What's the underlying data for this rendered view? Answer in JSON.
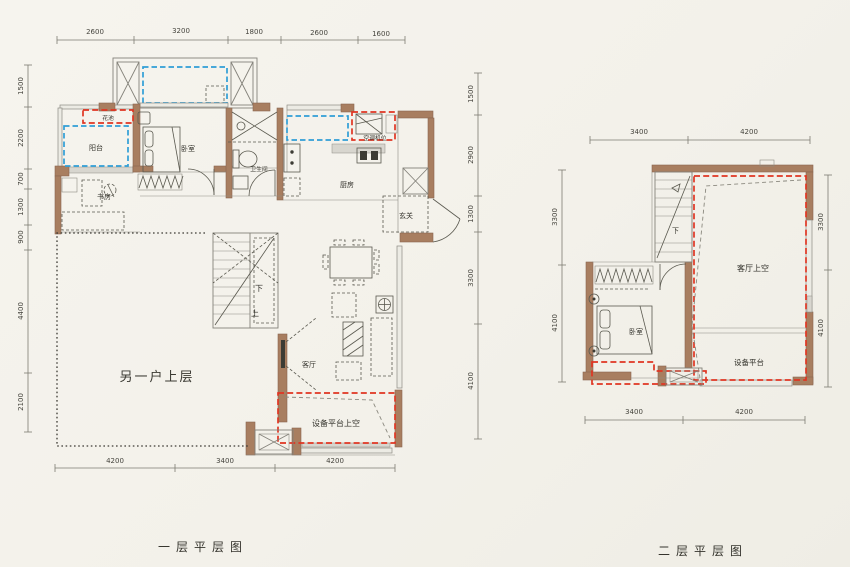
{
  "background": "#f4f2ec",
  "colors": {
    "wall": "#a87e60",
    "red_dash": "#e03522",
    "blue_dash": "#2f9ed6",
    "ink": "#34332c"
  },
  "floor1": {
    "title": "一层平层图",
    "dims": {
      "top": [
        "2600",
        "3200",
        "1800",
        "2600",
        "1600"
      ],
      "left": [
        "1500",
        "2200",
        "700",
        "1300",
        "900",
        "4400",
        "2100"
      ],
      "right": [
        "1500",
        "2900",
        "1300",
        "3300",
        "4100"
      ],
      "bottom": [
        "4200",
        "3400",
        "4200"
      ]
    },
    "labels": {
      "flower_bed": "花池",
      "balcony": "阳台",
      "bedroom": "卧室",
      "study": "书房",
      "bathroom": "卫生间",
      "kitchen": "厨房",
      "ac_unit": "空调机位",
      "foyer": "玄关",
      "living_room": "客厅",
      "other_unit_upper": "另一户上层",
      "equipment_platform_void": "设备平台上空",
      "stair_down": "下",
      "stair_up": "上"
    }
  },
  "floor2": {
    "title": "二层平层图",
    "dims": {
      "top": [
        "3400",
        "4200"
      ],
      "left": [
        "3300",
        "4100"
      ],
      "right": [
        "3300",
        "4100"
      ],
      "bottom": [
        "3400",
        "4200"
      ]
    },
    "labels": {
      "living_room_void": "客厅上空",
      "bedroom": "卧室",
      "equipment_platform": "设备平台",
      "stair_down": "下"
    }
  }
}
